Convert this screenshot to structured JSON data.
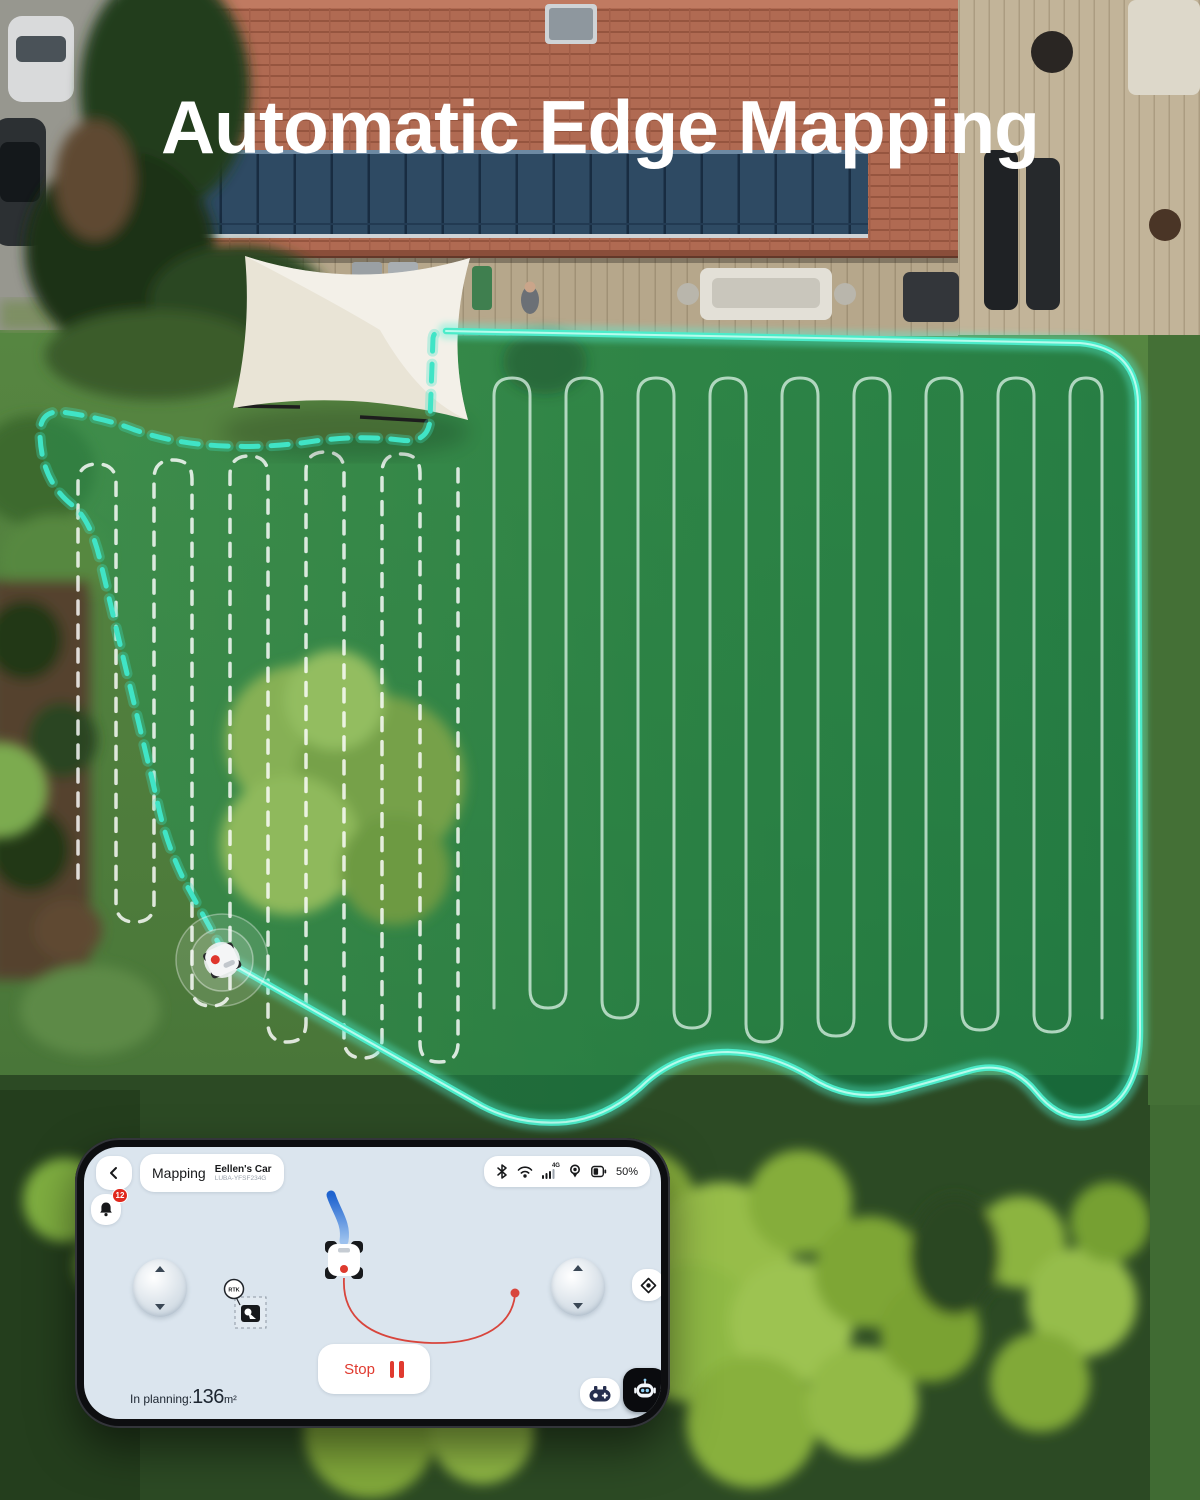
{
  "title": "Automatic Edge Mapping",
  "colors": {
    "boundary_teal": "#3FE2C5",
    "accent_red": "#E03A2F",
    "path_blue": "#2F7DE0",
    "screen_bg": "#DBE5EE",
    "badge_red": "#E0281D"
  },
  "phone": {
    "header": {
      "screen_label": "Mapping",
      "device_name": "Eellen's Car",
      "device_model": "LUBA-YFSF234G",
      "cellular_label": "4G",
      "battery_percent": "50%",
      "status_icons": [
        "bluetooth-icon",
        "wifi-icon",
        "cellular-4g-icon",
        "gps-location-icon",
        "battery-icon"
      ]
    },
    "notification_badge": "12",
    "map": {
      "rtk_label": "RTK"
    },
    "controls": {
      "stop_label": "Stop"
    },
    "footer": {
      "planning_label": "In planning:",
      "planning_value": "136",
      "planning_unit": "m²"
    }
  }
}
